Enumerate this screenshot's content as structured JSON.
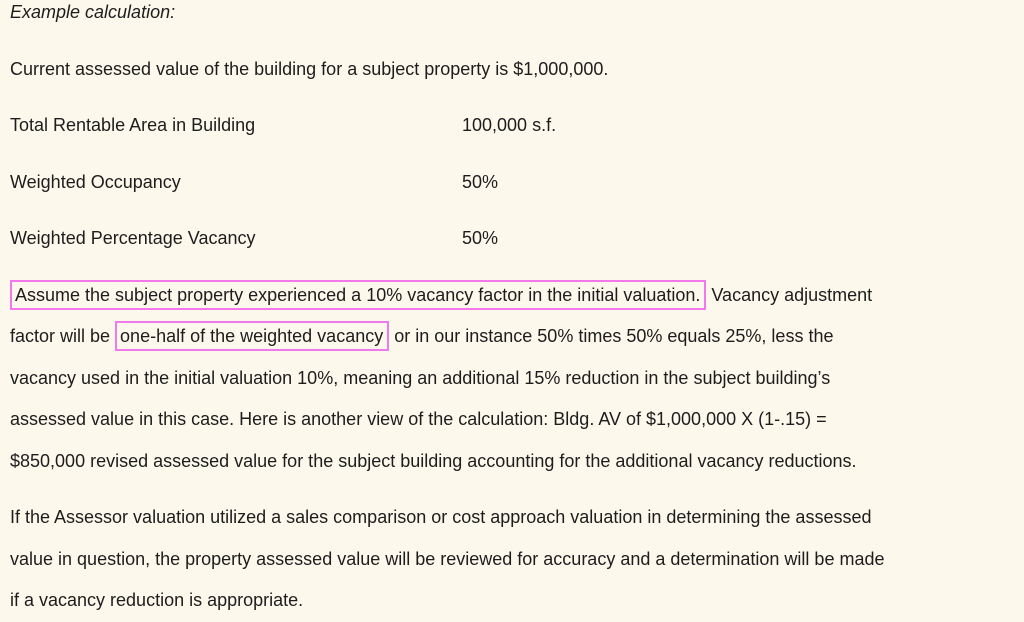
{
  "page": {
    "background_color": "#FDF8EC",
    "text_color": "#1D1D1D",
    "highlight_border_color": "#F278EB"
  },
  "heading": {
    "text": "Example calculation:"
  },
  "intro_paragraph": {
    "text": "Current assessed value of the building for a subject property is $1,000,000."
  },
  "facts_table": {
    "rows": [
      {
        "label": "Total Rentable Area in Building",
        "value": "100,000 s.f."
      },
      {
        "label": "Weighted Occupancy",
        "value": "50%"
      },
      {
        "label": "Weighted Percentage Vacancy",
        "value": "50%"
      }
    ]
  },
  "calculation_paragraph": {
    "lines": [
      [
        {
          "text": "Assume the subject property experienced a 10% vacancy factor in the initial valuation.",
          "boxed": true
        },
        {
          "text": " Vacancy adjustment",
          "boxed": false
        }
      ],
      [
        {
          "text": "factor will be ",
          "boxed": false
        },
        {
          "text": "one-half of the weighted vacancy",
          "boxed": true
        },
        {
          "text": " or in our instance 50% times 50% equals 25%, less the",
          "boxed": false
        }
      ],
      [
        {
          "text": "vacancy used in the initial valuation 10%, meaning an additional 15% reduction in the subject building’s",
          "boxed": false
        }
      ],
      [
        {
          "text": "assessed value in this case. Here is another view of the calculation: Bldg. AV of $1,000,000 X (1-.15) =",
          "boxed": false
        }
      ],
      [
        {
          "text": "$850,000 revised assessed value for the subject building accounting for the additional vacancy reductions.",
          "boxed": false
        }
      ]
    ]
  },
  "assessor_paragraph": {
    "lines": [
      [
        {
          "text": "If the Assessor valuation utilized a sales comparison or cost approach valuation in determining the assessed",
          "boxed": false
        }
      ],
      [
        {
          "text": "value in question, the property assessed value will be reviewed for accuracy and a determination will be made",
          "boxed": false
        }
      ],
      [
        {
          "text": "if a vacancy reduction is appropriate.",
          "boxed": false
        }
      ]
    ]
  }
}
